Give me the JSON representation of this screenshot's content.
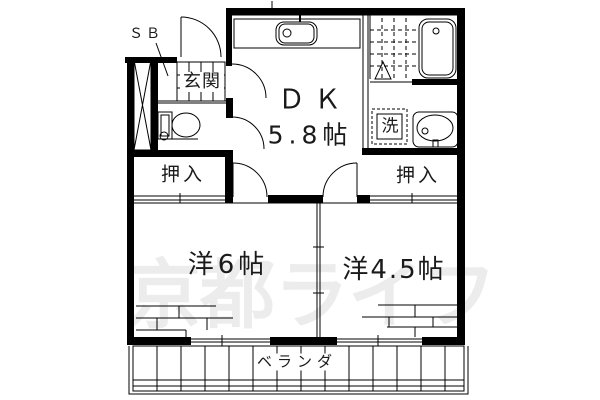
{
  "document": {
    "type": "floor-plan",
    "watermark": "京都ライフ"
  },
  "labels": {
    "shoe_box": "ＳＢ",
    "entrance": "玄関",
    "dining_kitchen": "ＤＫ",
    "dining_kitchen_size": "5.8帖",
    "laundry": "洗",
    "closet_left": "押入",
    "closet_right": "押入",
    "room_left": "洋6帖",
    "room_right": "洋4.5帖",
    "balcony": "ベランダ"
  },
  "rooms": [
    {
      "name": "dining-kitchen",
      "label": "ＤＫ",
      "size_jo": 5.8
    },
    {
      "name": "western-room-left",
      "label": "洋6帖",
      "size_jo": 6
    },
    {
      "name": "western-room-right",
      "label": "洋4.5帖",
      "size_jo": 4.5
    },
    {
      "name": "entrance",
      "label": "玄関"
    },
    {
      "name": "closet-left",
      "label": "押入"
    },
    {
      "name": "closet-right",
      "label": "押入"
    },
    {
      "name": "laundry-space",
      "label": "洗"
    },
    {
      "name": "balcony",
      "label": "ベランダ"
    },
    {
      "name": "shoe-box",
      "label": "ＳＢ"
    }
  ],
  "colors": {
    "line": "#000000",
    "background": "#ffffff",
    "watermark": "#ececec"
  }
}
